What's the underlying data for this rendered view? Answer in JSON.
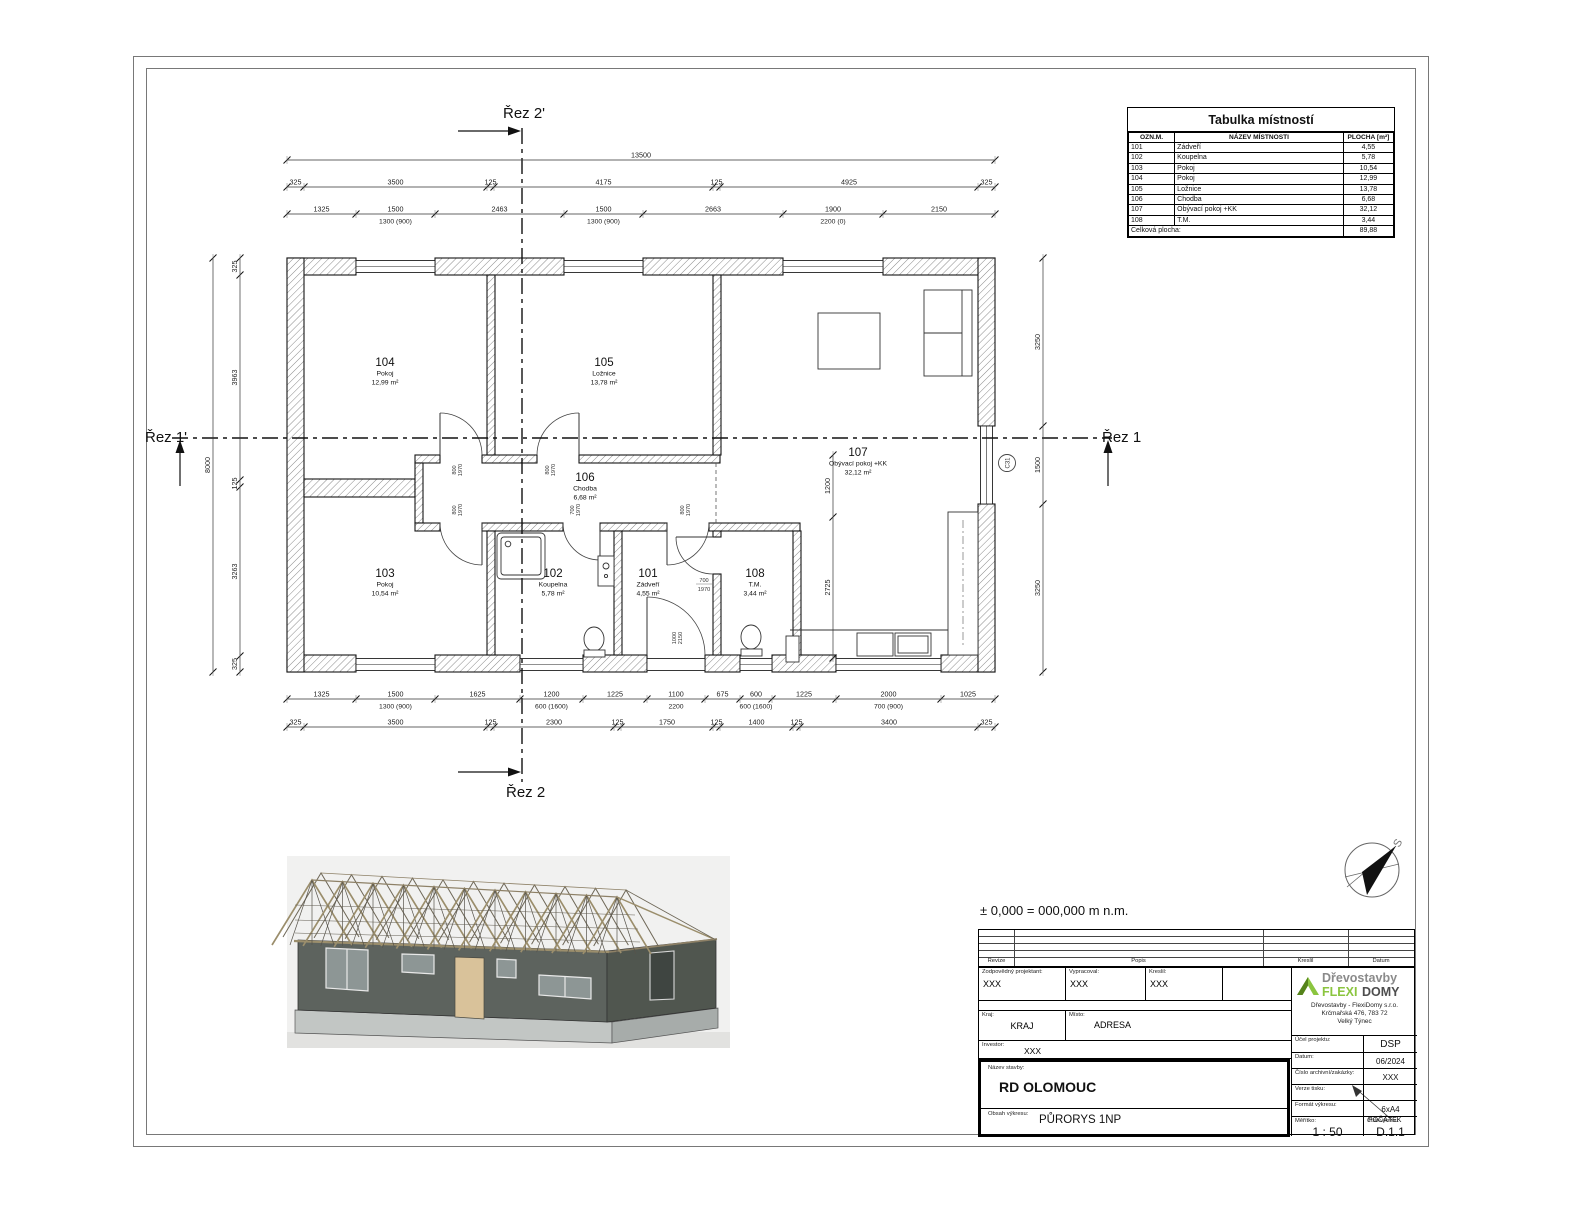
{
  "sheet": {
    "elevation_note": "± 0,000 = 000,000 m n.m."
  },
  "plan": {
    "section_labels": {
      "top": "Řez 2'",
      "bottom": "Řez 2",
      "left": "Řez 1'",
      "right": "Řez 1"
    },
    "compass_label": "S",
    "c_marker": "C31",
    "rooms": [
      {
        "number": "104",
        "name": "Pokoj",
        "area": "12,99 m²",
        "x": 385,
        "y": 366
      },
      {
        "number": "105",
        "name": "Ložnice",
        "area": "13,78 m²",
        "x": 604,
        "y": 366
      },
      {
        "number": "107",
        "name": "Obývací pokoj +KK",
        "area": "32,12 m²",
        "x": 858,
        "y": 456
      },
      {
        "number": "106",
        "name": "Chodba",
        "area": "6,68 m²",
        "x": 585,
        "y": 481
      },
      {
        "number": "103",
        "name": "Pokoj",
        "area": "10,54 m²",
        "x": 385,
        "y": 577
      },
      {
        "number": "102",
        "name": "Koupelna",
        "area": "5,78 m²",
        "x": 553,
        "y": 577
      },
      {
        "number": "101",
        "name": "Zádveří",
        "area": "4,55 m²",
        "x": 648,
        "y": 577
      },
      {
        "number": "108",
        "name": "T.M.",
        "area": "3,44 m²",
        "x": 755,
        "y": 577
      }
    ],
    "door_labels": [
      {
        "a": "800",
        "b": "1970",
        "x": 456,
        "y": 470,
        "rot": true
      },
      {
        "a": "800",
        "b": "1970",
        "x": 549,
        "y": 470,
        "rot": true
      },
      {
        "a": "800",
        "b": "1970",
        "x": 456,
        "y": 510,
        "rot": true
      },
      {
        "a": "700",
        "b": "1970",
        "x": 574,
        "y": 510,
        "rot": true
      },
      {
        "a": "800",
        "b": "1970",
        "x": 684,
        "y": 510,
        "rot": true
      },
      {
        "a": "700",
        "b": "1970",
        "x": 704,
        "y": 582,
        "rot": false
      },
      {
        "a": "1000",
        "b": "2150",
        "x": 676,
        "y": 638,
        "rot": true
      }
    ],
    "dims": {
      "h_rows": [
        {
          "y": 160,
          "x0": 287,
          "segments": [
            {
              "w": 708,
              "t": "13500"
            }
          ]
        },
        {
          "y": 187,
          "x0": 287,
          "segments": [
            {
              "w": 17,
              "t": "325"
            },
            {
              "w": 183,
              "t": "3500"
            },
            {
              "w": 7,
              "t": "125"
            },
            {
              "w": 219,
              "t": "4175"
            },
            {
              "w": 7,
              "t": "125"
            },
            {
              "w": 258,
              "t": "4925"
            },
            {
              "w": 17,
              "t": "325"
            }
          ]
        },
        {
          "y": 214,
          "x0": 287,
          "segments": [
            {
              "w": 69,
              "t": "1325"
            },
            {
              "w": 79,
              "t": "1500",
              "s": "1300 (900)"
            },
            {
              "w": 129,
              "t": "2463"
            },
            {
              "w": 79,
              "t": "1500",
              "s": "1300 (900)"
            },
            {
              "w": 140,
              "t": "2663"
            },
            {
              "w": 100,
              "t": "1900",
              "s": "2200 (0)"
            },
            {
              "w": 112,
              "t": "2150"
            }
          ]
        },
        {
          "y": 699,
          "x0": 287,
          "segments": [
            {
              "w": 69,
              "t": "1325"
            },
            {
              "w": 79,
              "t": "1500",
              "s": "1300 (900)"
            },
            {
              "w": 85,
              "t": "1625"
            },
            {
              "w": 63,
              "t": "1200",
              "s": "600 (1600)"
            },
            {
              "w": 64,
              "t": "1225"
            },
            {
              "w": 58,
              "t": "1100",
              "s": "2200"
            },
            {
              "w": 35,
              "t": "675"
            },
            {
              "w": 32,
              "t": "600",
              "s": "600 (1600)"
            },
            {
              "w": 64,
              "t": "1225"
            },
            {
              "w": 105,
              "t": "2000",
              "s": "700 (900)"
            },
            {
              "w": 54,
              "t": "1025"
            }
          ]
        },
        {
          "y": 727,
          "x0": 287,
          "segments": [
            {
              "w": 17,
              "t": "325"
            },
            {
              "w": 183,
              "t": "3500"
            },
            {
              "w": 7,
              "t": "125"
            },
            {
              "w": 120,
              "t": "2300"
            },
            {
              "w": 7,
              "t": "125"
            },
            {
              "w": 92,
              "t": "1750"
            },
            {
              "w": 7,
              "t": "125"
            },
            {
              "w": 73,
              "t": "1400"
            },
            {
              "w": 7,
              "t": "125"
            },
            {
              "w": 178,
              "t": "3400"
            },
            {
              "w": 17,
              "t": "325"
            }
          ]
        }
      ],
      "v_rows": [
        {
          "x": 213,
          "y0": 258,
          "segments": [
            {
              "w": 414,
              "t": "8000"
            }
          ]
        },
        {
          "x": 240,
          "y0": 258,
          "segments": [
            {
              "w": 17,
              "t": "325"
            },
            {
              "w": 205,
              "t": "3963"
            },
            {
              "w": 7,
              "t": "125"
            },
            {
              "w": 169,
              "t": "3263"
            },
            {
              "w": 16,
              "t": "325"
            }
          ]
        },
        {
          "x": 1043,
          "y0": 258,
          "segments": [
            {
              "w": 168,
              "t": "3250"
            },
            {
              "w": 78,
              "t": "1500"
            },
            {
              "w": 168,
              "t": "3250"
            }
          ]
        },
        {
          "x": 833,
          "y0": 455,
          "segments": [
            {
              "w": 62,
              "t": "1200"
            },
            {
              "w": 141,
              "t": "2725"
            }
          ]
        }
      ]
    }
  },
  "room_table": {
    "title": "Tabulka místností",
    "headers": [
      "OZN.M.",
      "NÁZEV MÍSTNOSTI",
      "PLOCHA [m²]"
    ],
    "rows": [
      [
        "101",
        "Zádveří",
        "4,55"
      ],
      [
        "102",
        "Koupelna",
        "5,78"
      ],
      [
        "103",
        "Pokoj",
        "10,54"
      ],
      [
        "104",
        "Pokoj",
        "12,99"
      ],
      [
        "105",
        "Ložnice",
        "13,78"
      ],
      [
        "106",
        "Chodba",
        "6,68"
      ],
      [
        "107",
        "Obývací pokoj +KK",
        "32,12"
      ],
      [
        "108",
        "T.M.",
        "3,44"
      ]
    ],
    "total_label": "Celková plocha:",
    "total_value": "89,88"
  },
  "titleblock": {
    "revision": {
      "headers": [
        "Revize",
        "Popis",
        "Kreslil",
        "Datum"
      ]
    },
    "fields": {
      "zodp_label": "Zodpovědný projektant:",
      "zodp_value": "XXX",
      "vypracoval_label": "Vypracoval:",
      "vypracoval_value": "XXX",
      "kreslil_label": "Kreslil:",
      "kreslil_value": "XXX",
      "kraj_label": "Kraj:",
      "kraj_value": "KRAJ",
      "misto_label": "Místo:",
      "misto_value": "ADRESA",
      "investor_label": "Investor:",
      "investor_value": "XXX",
      "nazev_label": "Název stavby:",
      "nazev_value": "RD OLOMOUC",
      "obsah_label": "Obsah výkresu:",
      "obsah_value": "PŮRORYS 1NP",
      "ucel_label": "Účel projektu:",
      "ucel_value": "DSP",
      "datum_label": "Datum:",
      "datum_value": "06/2024",
      "cislo_arch_label": "Číslo archivní/zakázky:",
      "cislo_arch_value": "XXX",
      "verze_label": "Verze tisku:",
      "verze_value": "",
      "format_label": "Formát výkresu:",
      "format_value": "6xA4",
      "meritko_label": "Měřítko:",
      "meritko_value": "1 : 50",
      "cislo_vykresu_label": "Číslo výkresu:",
      "cislo_vykresu_value": "D.1.1",
      "pocatek_note": "POČÁTEK"
    },
    "company": {
      "brand_prefix": "Dřevostavby",
      "brand_flexi": "FLEXI",
      "brand_domy": "DOMY",
      "address_lines": [
        "Dřevostavby - FlexiDomy s.r.o.",
        "Krčmařská 476, 783 72",
        "Velký Týnec"
      ]
    },
    "colors": {
      "brand_green": "#8bc53f",
      "brand_darkgreen": "#55831b",
      "brand_gray": "#8a8a8a",
      "brand_dark": "#4d4d4d"
    }
  }
}
